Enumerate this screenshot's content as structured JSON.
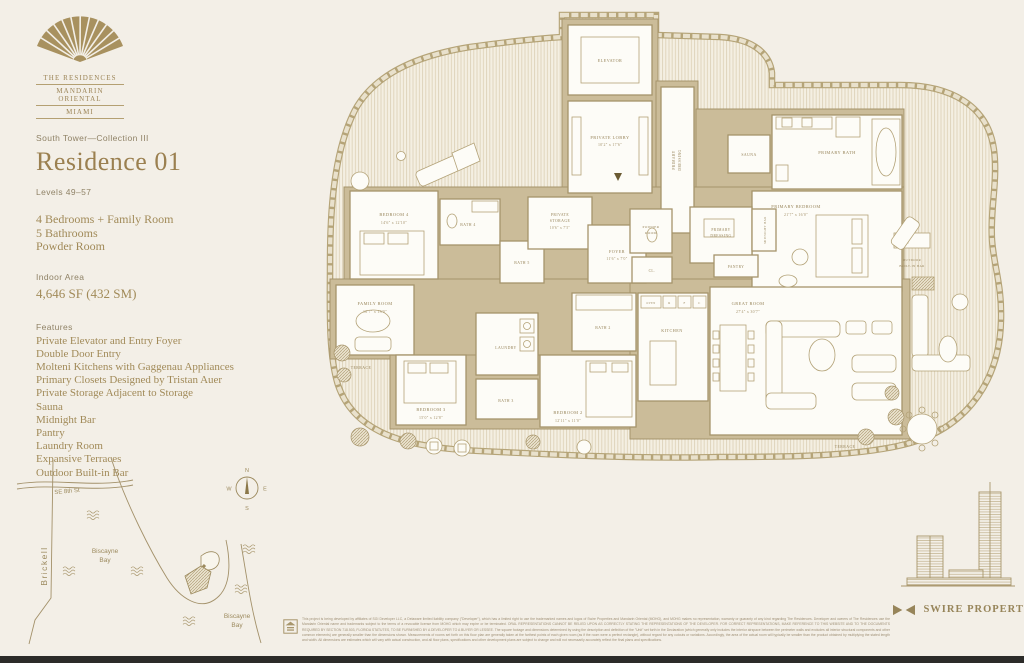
{
  "brand": {
    "line1": "THE RESIDENCES",
    "line2": "MANDARIN ORIENTAL",
    "line3": "MIAMI"
  },
  "header": {
    "collection": "South Tower—Collection III",
    "residence": "Residence 01",
    "levels": "Levels 49–57"
  },
  "summary": {
    "bedrooms": "4 Bedrooms + Family Room",
    "bathrooms": "5 Bathrooms",
    "powder": "Powder Room",
    "area_label": "Indoor Area",
    "area_value": "4,646 SF (432 SM)"
  },
  "features": {
    "title": "Features",
    "items": [
      "Private Elevator and Entry Foyer",
      "Double Door Entry",
      "Molteni Kitchens with Gaggenau Appliances",
      "Primary Closets Designed by Tristan Auer",
      "Private Storage Adjacent to Storage",
      "Sauna",
      "Midnight Bar",
      "Pantry",
      "Laundry Room",
      "Expansive Terraces",
      "Outdoor Built-in Bar"
    ]
  },
  "plan": {
    "elevator": "ELEVATOR",
    "private_lobby": "PRIVATE LOBBY",
    "private_lobby_dims": "10'2\" x 17'6\"",
    "primary_dressing_l1": "PRIMARY",
    "primary_dressing_l2": "DRESSING",
    "sauna": "SAUNA",
    "primary_bath": "PRIMARY BATH",
    "primary_bedroom": "PRIMARY BEDROOM",
    "primary_bedroom_dims": "21'7\" x 16'0\"",
    "pantry": "PANTRY",
    "midnight_bar": "MIDNIGHT BAR",
    "bedroom4": "BEDROOM 4",
    "bedroom4_dims": "14'6\" x 12'10\"",
    "bath4": "BATH 4",
    "bath5": "BATH 5",
    "storage_l1": "PRIVATE",
    "storage_l2": "STORAGE",
    "storage_dims": "10'6\" x 7'5\"",
    "foyer": "FOYER",
    "foyer_dims": "11'6\" x 7'0\"",
    "powder_l1": "POWDER",
    "powder_l2": "ROOM",
    "closet": "CL.",
    "family_room": "FAMILY ROOM",
    "family_room_dims": "16'7\" x 13'0\"",
    "bedroom3": "BEDROOM 3",
    "bedroom3_dims": "15'0\" x 12'8\"",
    "laundry": "LAUNDRY",
    "bath3": "BATH 3",
    "bath2": "BATH 2",
    "bedroom2": "BEDROOM 2",
    "bedroom2_dims": "12'11\" x 11'0\"",
    "kitchen": "KITCHEN",
    "great_room": "GREAT ROOM",
    "great_room_dims": "27'4\" x 30'7\"",
    "terrace": "TERRACE",
    "outdoor_bar_l1": "OUTDOOR",
    "outdoor_bar_l2": "BUILT-IN BAR",
    "appliance_oven": "OVEN",
    "appliance_r": "R",
    "appliance_f": "F",
    "appliance_c": "C"
  },
  "map": {
    "street": "SE 8th St",
    "district": "Brickell",
    "bay_l1": "Biscayne",
    "bay_l2": "Bay",
    "compass_n": "N",
    "compass_e": "E",
    "compass_s": "S",
    "compass_w": "W"
  },
  "developer": {
    "name": "SWIRE PROPERTIES"
  },
  "footer": {
    "disclaimer": "This project is being developed by affiliates of SGI Developer LLC, a Delaware limited liability company (\"Developer\"), which has a limited right to use the trademarked names and logos of Swire Properties and Mandarin Oriental (MOHG), and MOHG makes no representation, warranty or guaranty of any kind regarding The Residences. Developer and owners of The Residences use the Mandarin Oriental name and trademarks subject to the terms of a revocable license from MOHG which may expire or be terminated. ORAL REPRESENTATIONS CANNOT BE RELIED UPON AS CORRECTLY STATING THE REPRESENTATIONS OF THE DEVELOPER. FOR CORRECT REPRESENTATIONS, MAKE REFERENCE TO THIS WEBSITE AND TO THE DOCUMENTS REQUIRED BY SECTION 718.503, FLORIDA STATUTES, TO BE FURNISHED BY A DEVELOPER TO A BUYER OR LESSEE. The square footage and dimensions determined by using the description and definition of the \"Unit\" set forth in the Declaration (which generally only includes the interior airspace between the perimeter walls and excludes all interior structural components and other common elements) are generally smaller than the dimensions shown. Measurements of rooms set forth on this floor plan are generally taken at the farthest points of each given room (as if the room were a perfect rectangle), without regard for any cutouts or variations. Accordingly, the area of the actual room will typically be smaller than the product obtained by multiplying the stated length and width. All dimensions are estimates which will vary with actual construction, and all floor plans, specifications and other development plans are subject to change and will not necessarily accurately reflect the final plans and specifications."
  }
}
